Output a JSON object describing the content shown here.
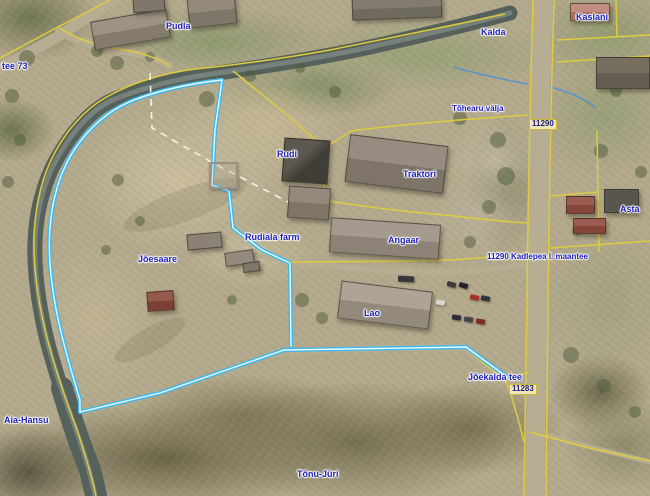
{
  "map": {
    "colors": {
      "selection": "#3fb8ea",
      "selection_core": "#eafaff",
      "cadastral": "#decb3e",
      "river": "#57615b",
      "river_highlight": "#7f8a83",
      "road": "#b6ad92",
      "stream": "#4a90d9",
      "dashed_boundary": "#f2f2ea",
      "label_text": "#1c1cb4"
    },
    "labels": {
      "pudla": "Pudla",
      "kalda": "Kalda",
      "kaslani": "Kaslani",
      "partial_address": "i tee 73",
      "tohearu_valja": "Tõhearu välja",
      "rudi": "Rudi",
      "traktori": "Traktori",
      "asta": "Asta",
      "angaar": "Angaar",
      "rudiala_farm": "Rudiala farm",
      "joesaare": "Jõesaare",
      "road_name": "11290 Kadlepea l. maantee",
      "lao": "Lao",
      "joekalda_tee": "Jõekalda tee",
      "aia_hansu": "Aia-Hansu",
      "tonu_juri": "Tõnu-Jüri"
    },
    "road_signs": {
      "north": "11290",
      "south": "11283"
    }
  }
}
